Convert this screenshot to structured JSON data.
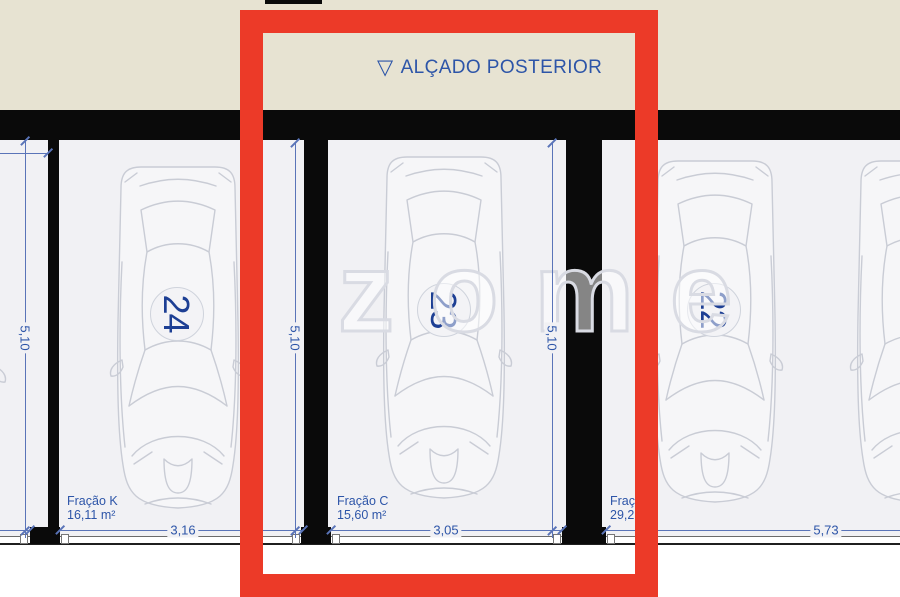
{
  "colors": {
    "red_frame": "#ec3a28",
    "beige": "#e7e3d2",
    "floor": "#f1f1f4",
    "wall_black": "#0a0a0a",
    "dim_blue": "#5a74b8",
    "text_blue": "#2d55a8",
    "number_navy": "#1d3f94",
    "car_line": "#c9ccd5",
    "watermark_gray": "#d9dbe3"
  },
  "title": {
    "triangle": "▽",
    "text": "ALÇADO POSTERIOR"
  },
  "watermark_text": "zome",
  "spaces": {
    "left_partial": {
      "depth": "5,10"
    },
    "s24": {
      "number": "24",
      "fraction": "Fração K",
      "area": "16,11 m²",
      "width": "3,16",
      "depth": "5,10"
    },
    "s23": {
      "number": "23",
      "fraction": "Fração C",
      "area": "15,60 m²",
      "width": "3,05",
      "depth": "5,10"
    },
    "s22": {
      "number": "22",
      "fraction_cut": "Fraçã",
      "area_cut": "29,21",
      "width": "5,73"
    }
  }
}
